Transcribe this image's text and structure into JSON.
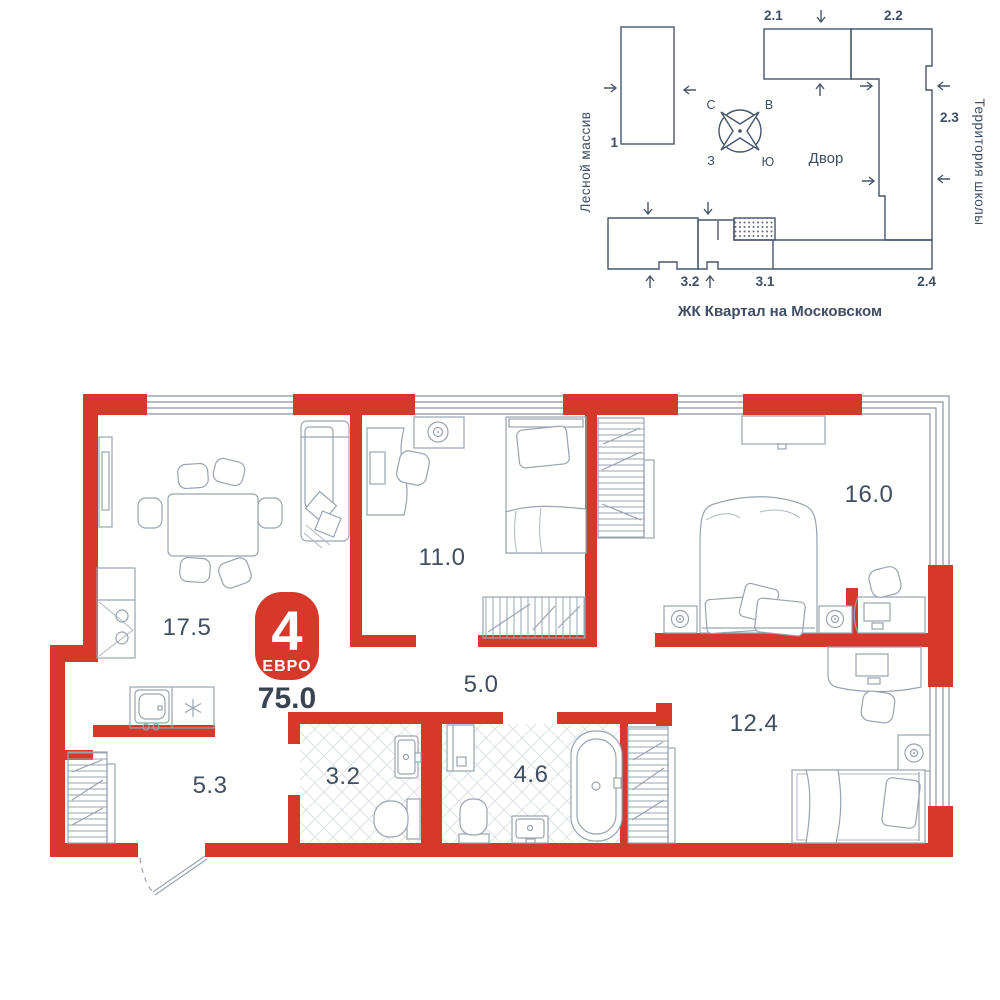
{
  "site_plan": {
    "left_area_label": "Лесной массив",
    "right_area_label": "Территория школы",
    "courtyard_label": "Двор",
    "complex_name": "ЖК Квартал на Московском",
    "highlighted_building": "3.1",
    "compass": {
      "north": "С",
      "east": "В",
      "south": "Ю",
      "west": "З"
    },
    "building_labels": {
      "b1": "1",
      "b21": "2.1",
      "b22": "2.2",
      "b23": "2.3",
      "b24": "2.4",
      "b31": "3.1",
      "b32": "3.2"
    }
  },
  "apartment": {
    "layout_badge": {
      "number": "4",
      "type": "ЕВРО"
    },
    "total_area": "75.0",
    "rooms": [
      {
        "id": "kitchen-living",
        "area": "17.5"
      },
      {
        "id": "bedroom-1",
        "area": "11.0"
      },
      {
        "id": "bedroom-2",
        "area": "16.0"
      },
      {
        "id": "corridor",
        "area": "5.0"
      },
      {
        "id": "bedroom-3",
        "area": "12.4"
      },
      {
        "id": "hallway",
        "area": "5.3"
      },
      {
        "id": "wc",
        "area": "3.2"
      },
      {
        "id": "bathroom",
        "area": "4.6"
      }
    ],
    "colors": {
      "walls": "#d6382b",
      "siteplan_lines": "#46566c",
      "labels": "#414e5f"
    }
  }
}
